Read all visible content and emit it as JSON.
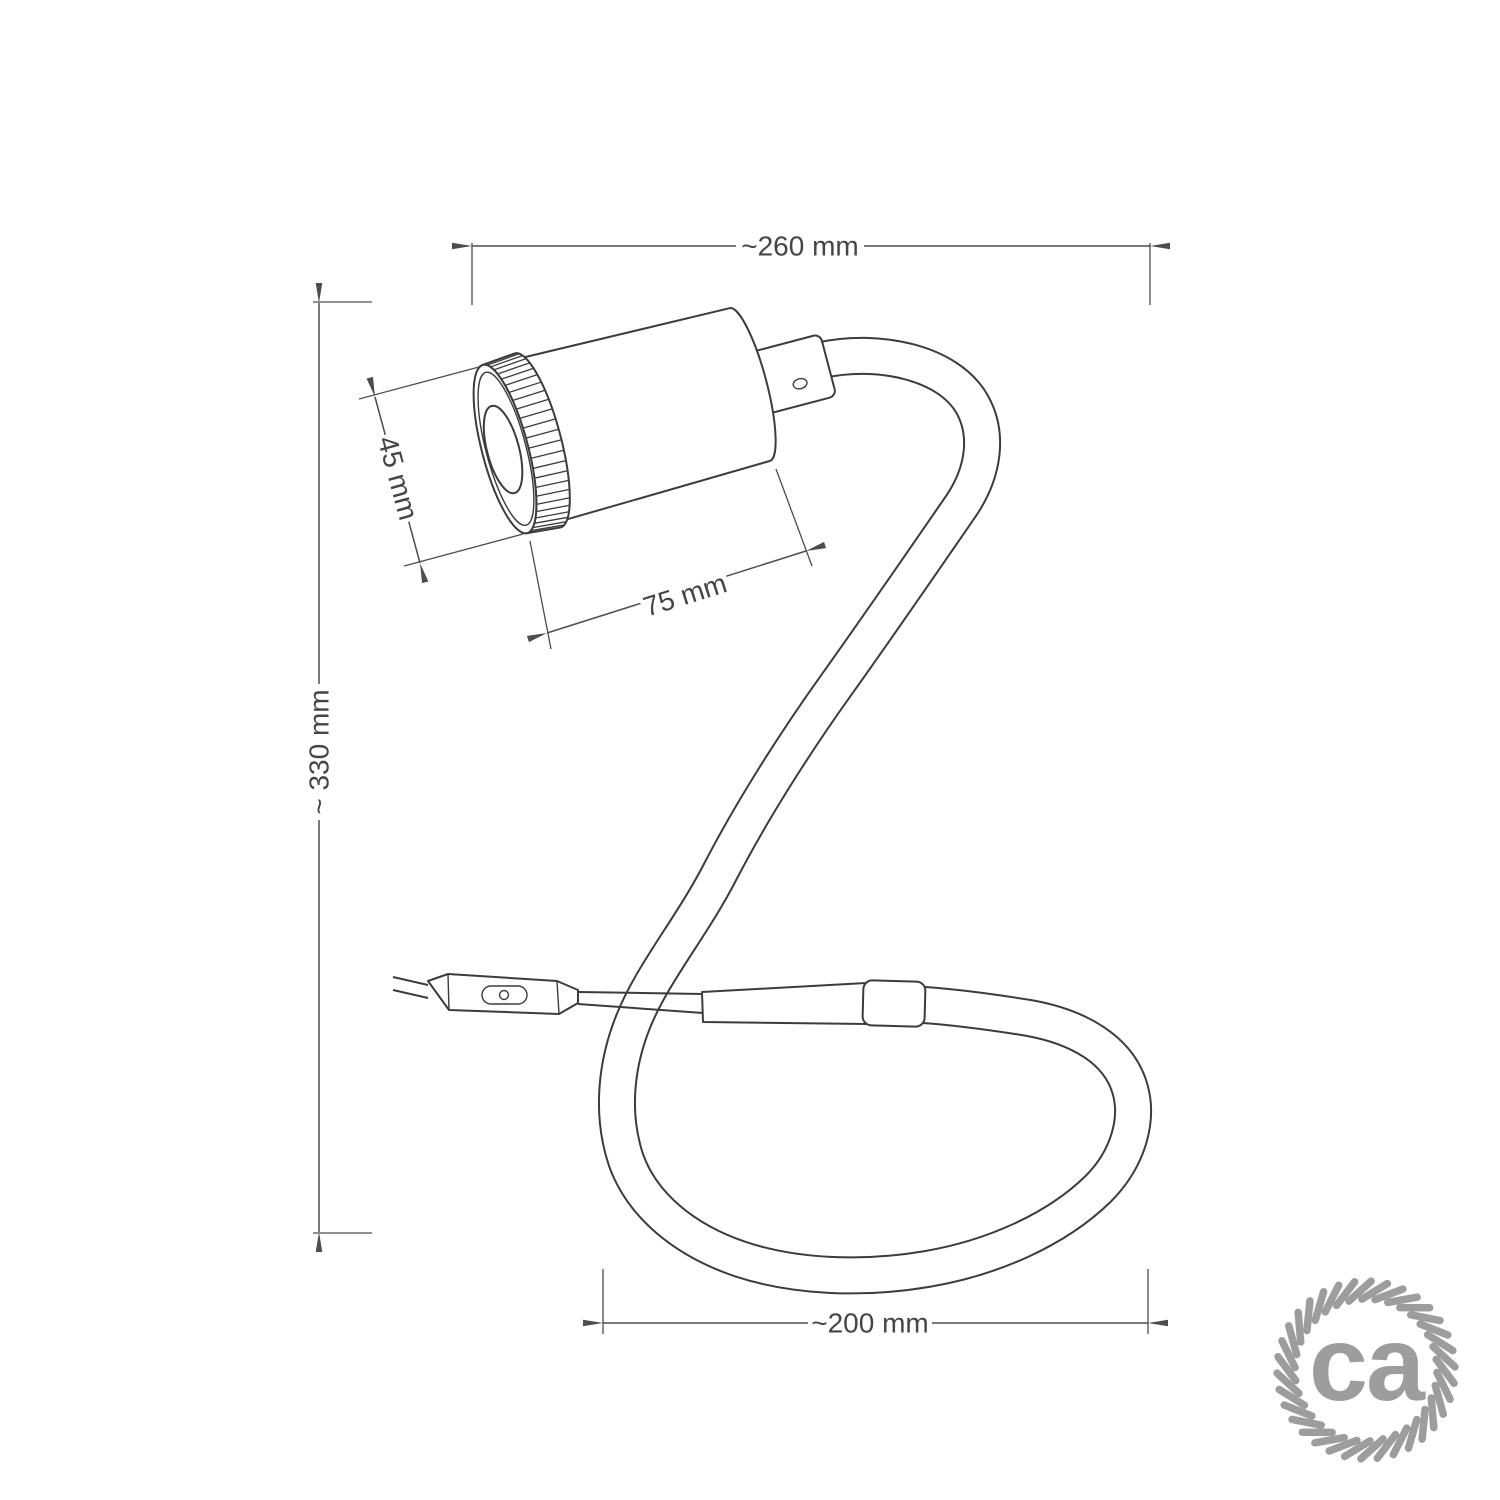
{
  "dimensions": {
    "overall_width": "~260 mm",
    "overall_height": "~ 330 mm",
    "head_diameter": "45 mm",
    "head_length": "75 mm",
    "loop_width": "~200 mm"
  },
  "logo": {
    "text": "ca"
  },
  "colors": {
    "drawing_line": "#3c3c3c",
    "dimension_line": "#4d4d4d",
    "label_text": "#454545",
    "logo": "#9d9d9d",
    "background": "#ffffff"
  }
}
